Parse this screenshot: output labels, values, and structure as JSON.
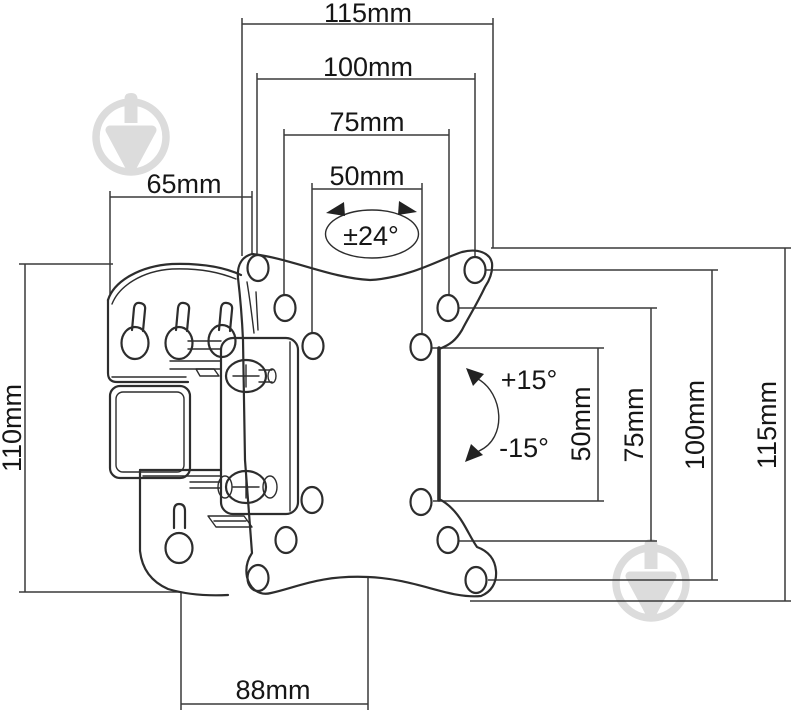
{
  "diagram": {
    "title": "TV wall mount bracket dimensional drawing",
    "type": "technical line drawing",
    "units": "mm",
    "colors": {
      "background": "#ffffff",
      "line": "#2d2d2d",
      "dimension_line": "#3a3a3a",
      "watermark": "#dcdcdc"
    },
    "watermark_icon": "spinning-top-logo",
    "dimensions": {
      "top_width_115": "115mm",
      "top_width_100": "100mm",
      "top_width_75": "75mm",
      "top_width_50": "50mm",
      "wall_plate_width_65": "65mm",
      "wall_plate_height_110": "110mm",
      "bottom_depth_88": "88mm",
      "right_height_50": "50mm",
      "right_height_75": "75mm",
      "right_height_100": "100mm",
      "right_height_115": "115mm"
    },
    "angles": {
      "swivel_range": "±24°",
      "tilt_up": "+15°",
      "tilt_down": "-15°"
    }
  }
}
